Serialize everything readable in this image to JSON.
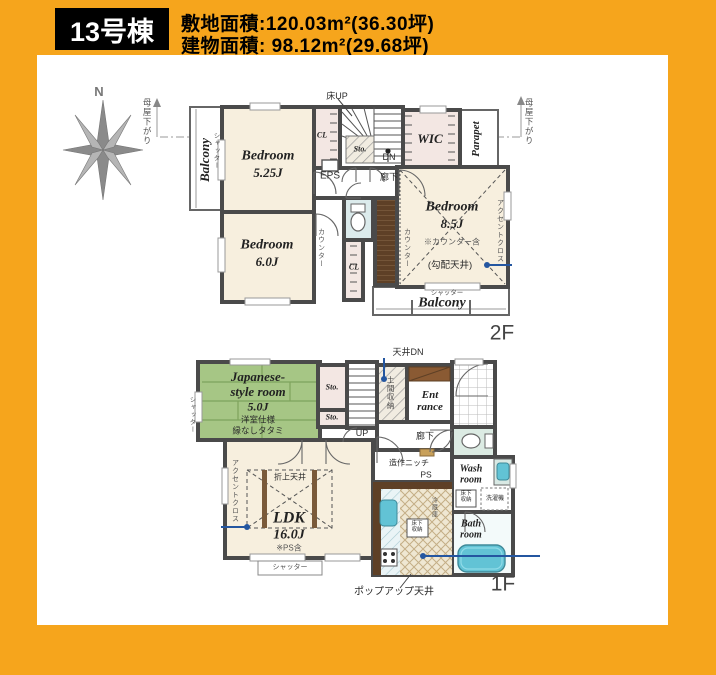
{
  "theme": {
    "frame_orange": "#F6A51C",
    "wall_gray": "#4a4a4a",
    "room_beige": "#F7EFDE",
    "closet_pink": "#F3E7E3",
    "tatami_green": "#A6C685",
    "water_teal": "#62C3D5",
    "annotation_blue": "#2456A0"
  },
  "header": {
    "unit_label": "13号棟",
    "site_area": "敷地面積:120.03m²(36.30坪)",
    "building_area": "建物面積: 98.12m²(29.68坪)"
  },
  "compass": {
    "north": "N"
  },
  "floor2": {
    "label": "2F",
    "bedroom_a": {
      "name": "Bedroom",
      "size": "5.25J"
    },
    "bedroom_b": {
      "name": "Bedroom",
      "size": "6.0J"
    },
    "bedroom_c": {
      "name": "Bedroom",
      "size": "8.5J",
      "note_counter": "※カウンター含",
      "note_ceiling": "(勾配天井)"
    },
    "wic": "WIC",
    "parapet": "Parapet",
    "balcony_left": "Balcony",
    "balcony_bottom": "Balcony",
    "shutter_left": "シャッター",
    "shutter_bottom": "シャッター",
    "cl_top": "CL",
    "cl_bottom": "CL",
    "sto": "Sto.",
    "eps": "EPS",
    "dn": "DN",
    "floor_up": "床UP",
    "hallway": "廊下",
    "counter_left": "カウンター",
    "counter_right": "カウンター",
    "accent_cloth": "アクセントクロス",
    "eaves_left": "母屋下がり",
    "eaves_right": "母屋下がり"
  },
  "floor1": {
    "label": "1F",
    "jroom": {
      "name_line1": "Japanese-",
      "name_line2": "style room",
      "size": "5.0J",
      "note1": "洋室仕様",
      "note2": "縁なしタタミ"
    },
    "ldk": {
      "name": "LDK",
      "size": "16.0J",
      "note": "※PS含",
      "ceiling": "折上天井"
    },
    "entrance": {
      "line1": "Ent",
      "line2": "rance"
    },
    "wash": {
      "line1": "Wash",
      "line2": "room"
    },
    "bath": {
      "line1": "Bath",
      "line2": "room"
    },
    "sto_a": "Sto.",
    "sto_b": "Sto.",
    "up": "UP",
    "ceiling_dn": "天井DN",
    "doma": "土間収納",
    "hallway": "廊下",
    "niche": "造作ニッチ",
    "ps": "PS",
    "floor_storage_wash": "床下収納",
    "floor_storage_kitchen": "床下収納",
    "washer": "洗濯機",
    "fridge": "冷蔵庫",
    "shutter_left": "シャッター",
    "shutter_bottom": "シャッター",
    "accent_cloth": "アクセントクロス",
    "popup_ceiling": "ポップアップ天井"
  }
}
